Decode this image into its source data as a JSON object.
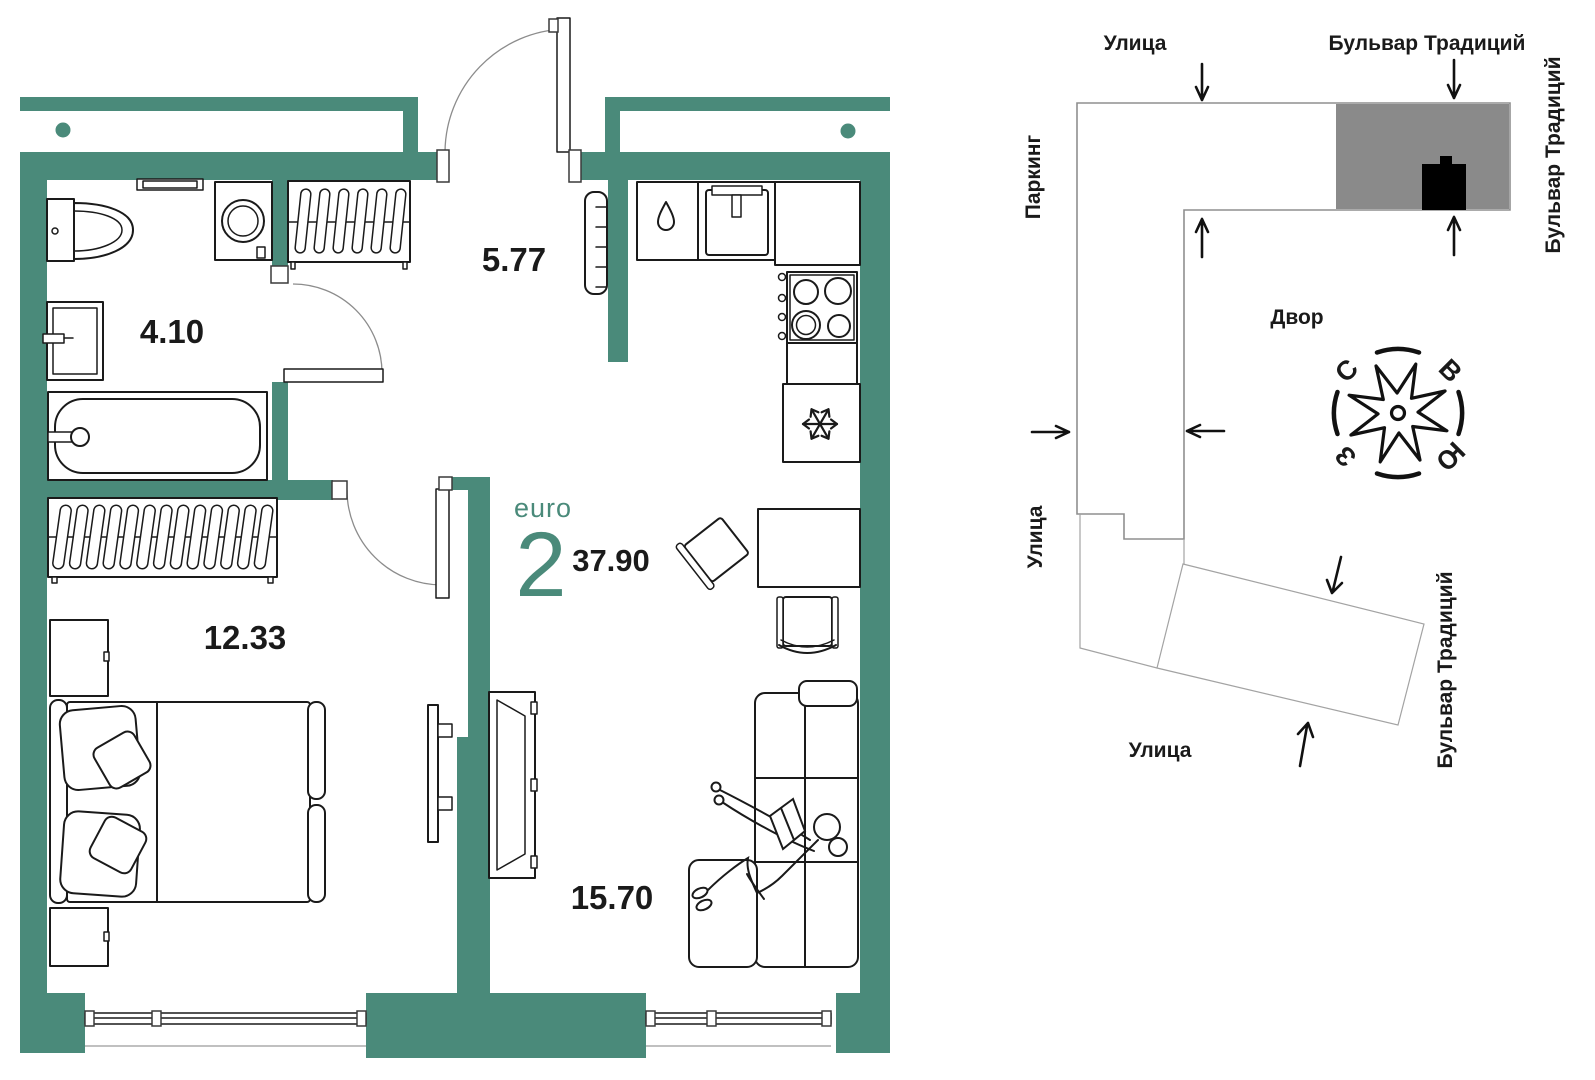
{
  "plan": {
    "euro_label": "euro",
    "rooms_count": "2",
    "total_area": "37.90",
    "areas": {
      "hallway": "5.77",
      "bathroom": "4.10",
      "bedroom": "12.33",
      "living": "15.70"
    }
  },
  "site": {
    "street_top": "Улица",
    "boulevard_top": "Бульвар Традиций",
    "boulevard_right": "Бульвар Традиций",
    "parking": "Паркинг",
    "courtyard": "Двор",
    "street_left": "Улица",
    "street_bottom": "Улица",
    "boulevard_bottom": "Бульвар Традиций",
    "compass": {
      "n": "С",
      "e": "В",
      "s": "Ю",
      "w": "З"
    }
  },
  "colors": {
    "wall_teal": "#4a8a7a",
    "highlight_building_gray": "#8a8a8a",
    "current_building_black": "#000000",
    "line_black": "#1a1a1a"
  }
}
